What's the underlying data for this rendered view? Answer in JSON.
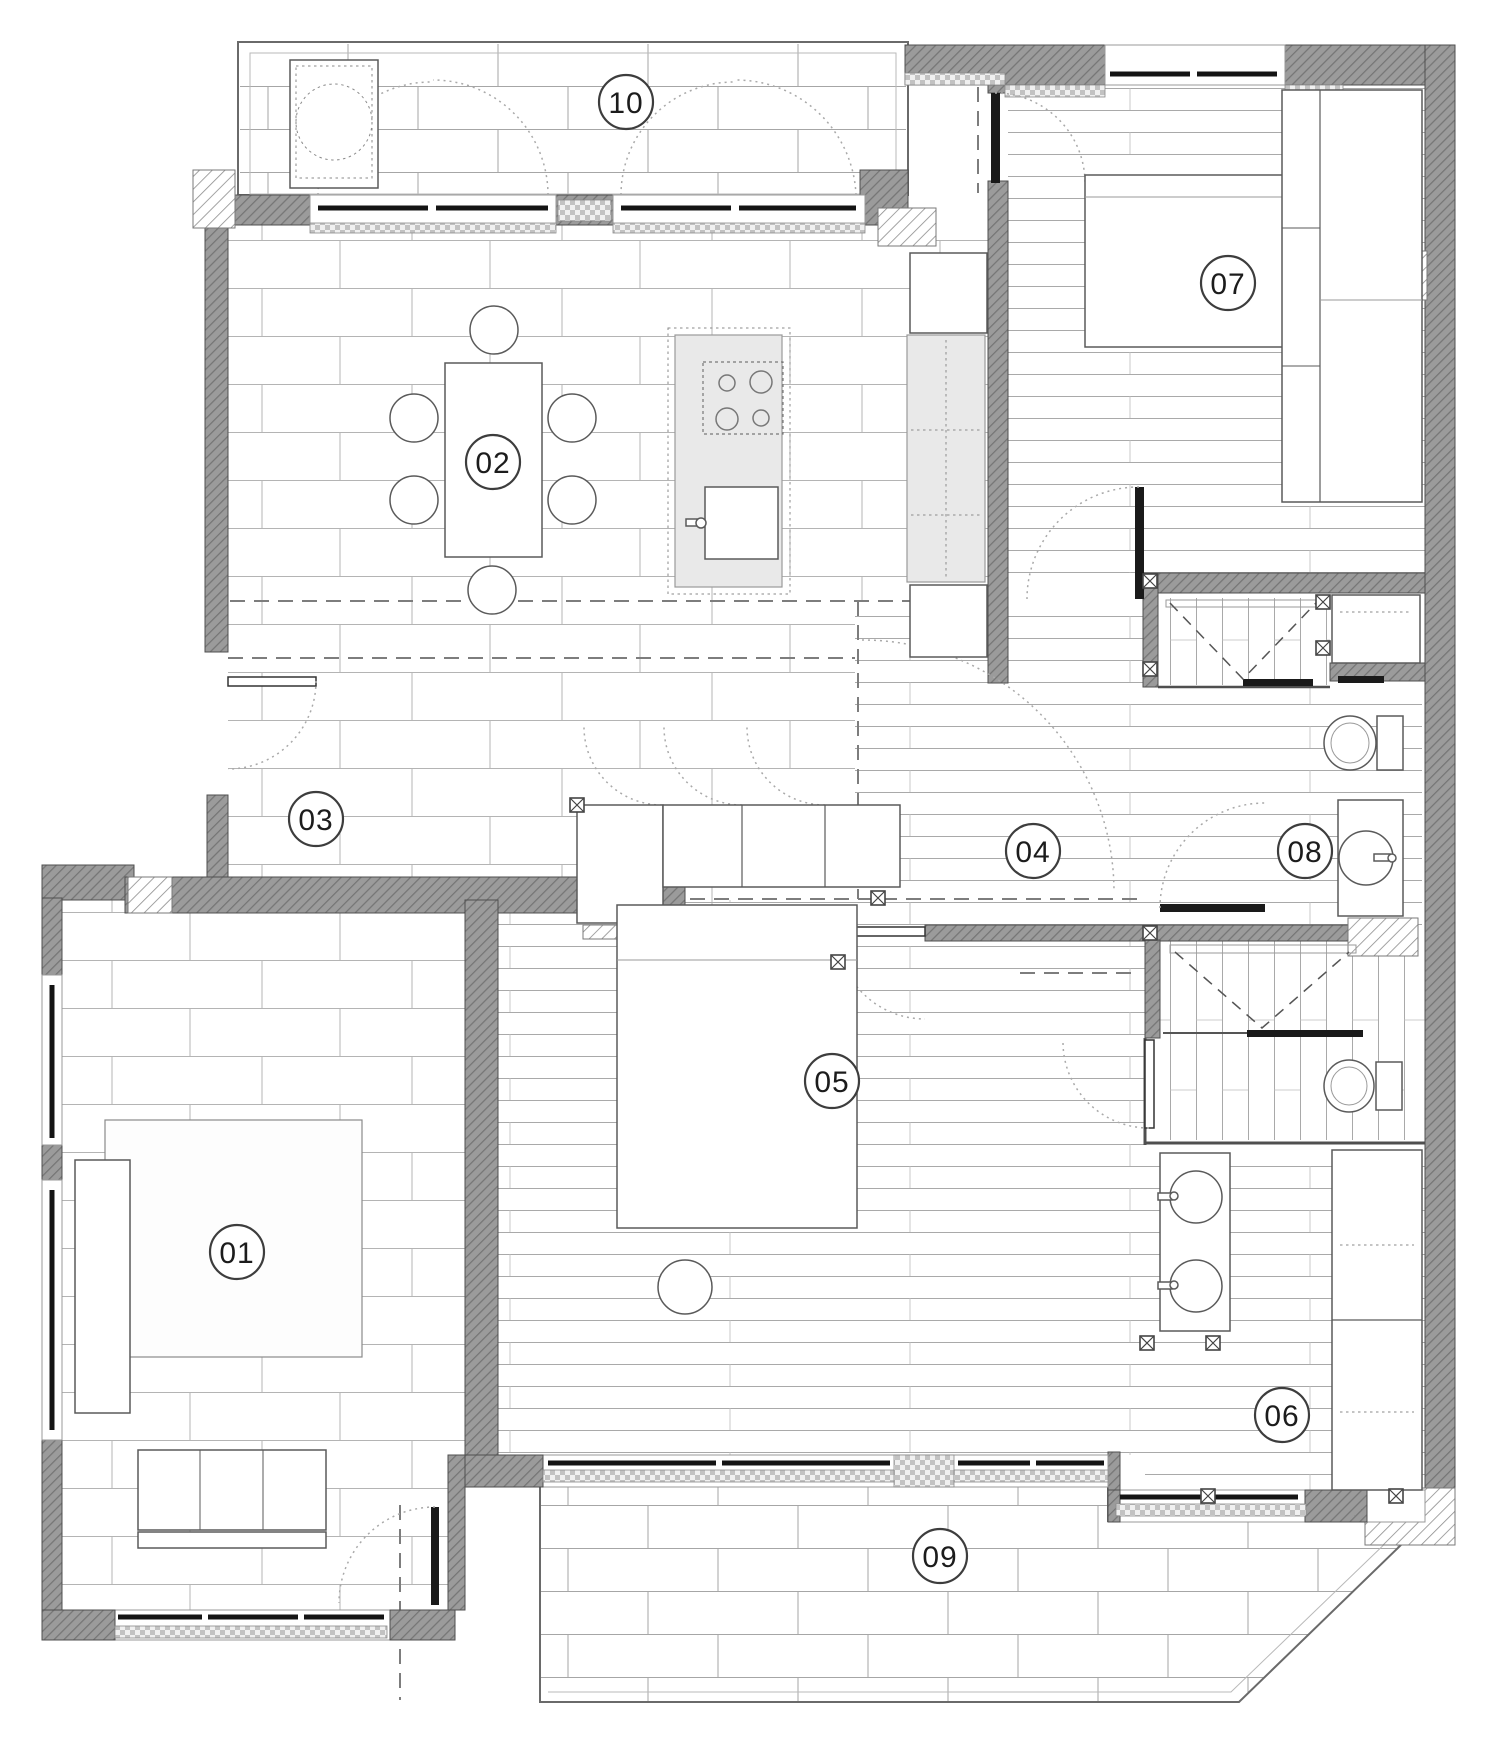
{
  "rooms": [
    {
      "number": "01"
    },
    {
      "number": "02"
    },
    {
      "number": "03"
    },
    {
      "number": "04"
    },
    {
      "number": "05"
    },
    {
      "number": "06"
    },
    {
      "number": "07"
    },
    {
      "number": "08"
    },
    {
      "number": "09"
    },
    {
      "number": "10"
    }
  ],
  "colors": {
    "wall_fill": "#9b9b9b",
    "wall_hatch": "#757575",
    "light_hatch": "#8c8c8c",
    "outline": "#4f4f4f",
    "tile_line": "#b4b4b4",
    "terrace_tile_line": "#a6a6a6",
    "plank_line": "#a9a9a9",
    "counter_fill": "#e9e9e9",
    "glazing": "#141414",
    "dashed_beam": "#7d7d7d",
    "swing_arc": "#a9a9a9",
    "label_stroke": "#3d3d3d",
    "label_text": "#1c1c1c",
    "background": "#ffffff"
  }
}
